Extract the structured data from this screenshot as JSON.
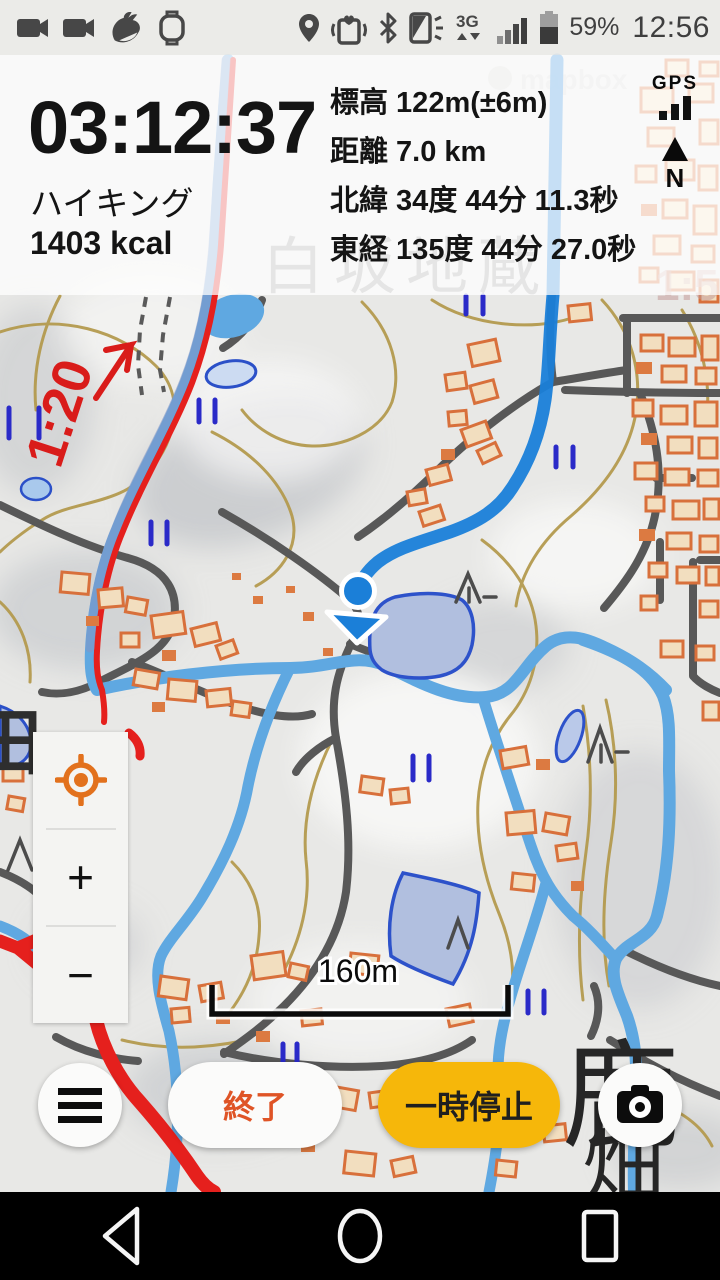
{
  "status_bar": {
    "time": "12:56",
    "battery_percent": "59%",
    "network_type": "3G",
    "left_icon_names": [
      "video-camera-icon",
      "video-camera-icon",
      "bird-app-icon",
      "smartwatch-icon"
    ],
    "right_icon_names": [
      "location-pin-icon",
      "phone-heart-vibrate-icon",
      "bluetooth-icon",
      "screen-flash-icon",
      "network-3g-icon",
      "signal-bars-icon",
      "battery-icon"
    ]
  },
  "stats_panel": {
    "timer": "03:12:37",
    "activity": "ハイキング",
    "calories": "1403 kcal",
    "elevation": "標高 122m(±6m)",
    "distance": "距離 7.0 km",
    "latitude": "北緯 34度 44分 11.3秒",
    "longitude": "東経 135度 44分 27.0秒",
    "gps_label": "GPS",
    "compass_label": "N"
  },
  "map": {
    "scale_label": "160m",
    "slope_label": "1:20",
    "place_label_top": "白坂地蔵",
    "place_label_bottom_1": "鹿",
    "place_label_bottom_2": "畑",
    "edge_label_left": "田",
    "edge_label_right": "1:5",
    "watermark": "mapbox",
    "colors": {
      "gps_track": "#1a7fd9",
      "stream": "#5fa8e1",
      "route_red": "#e5201d",
      "pond_fill": "#b1bfdf",
      "pond_border": "#2d52ca",
      "contour": "#b49a4e",
      "road": "#585858",
      "building_outline": "#d8703b",
      "building_fill": "#f2debf"
    }
  },
  "map_controls": {
    "zoom_in": "+",
    "zoom_out": "−",
    "locate_color": "#e2711d"
  },
  "action_bar": {
    "end_button": "終了",
    "pause_button": "一時停止",
    "pause_color": "#f6b70a"
  },
  "nav_bar": {
    "icon_names": [
      "back-icon",
      "home-icon",
      "recents-icon"
    ]
  }
}
